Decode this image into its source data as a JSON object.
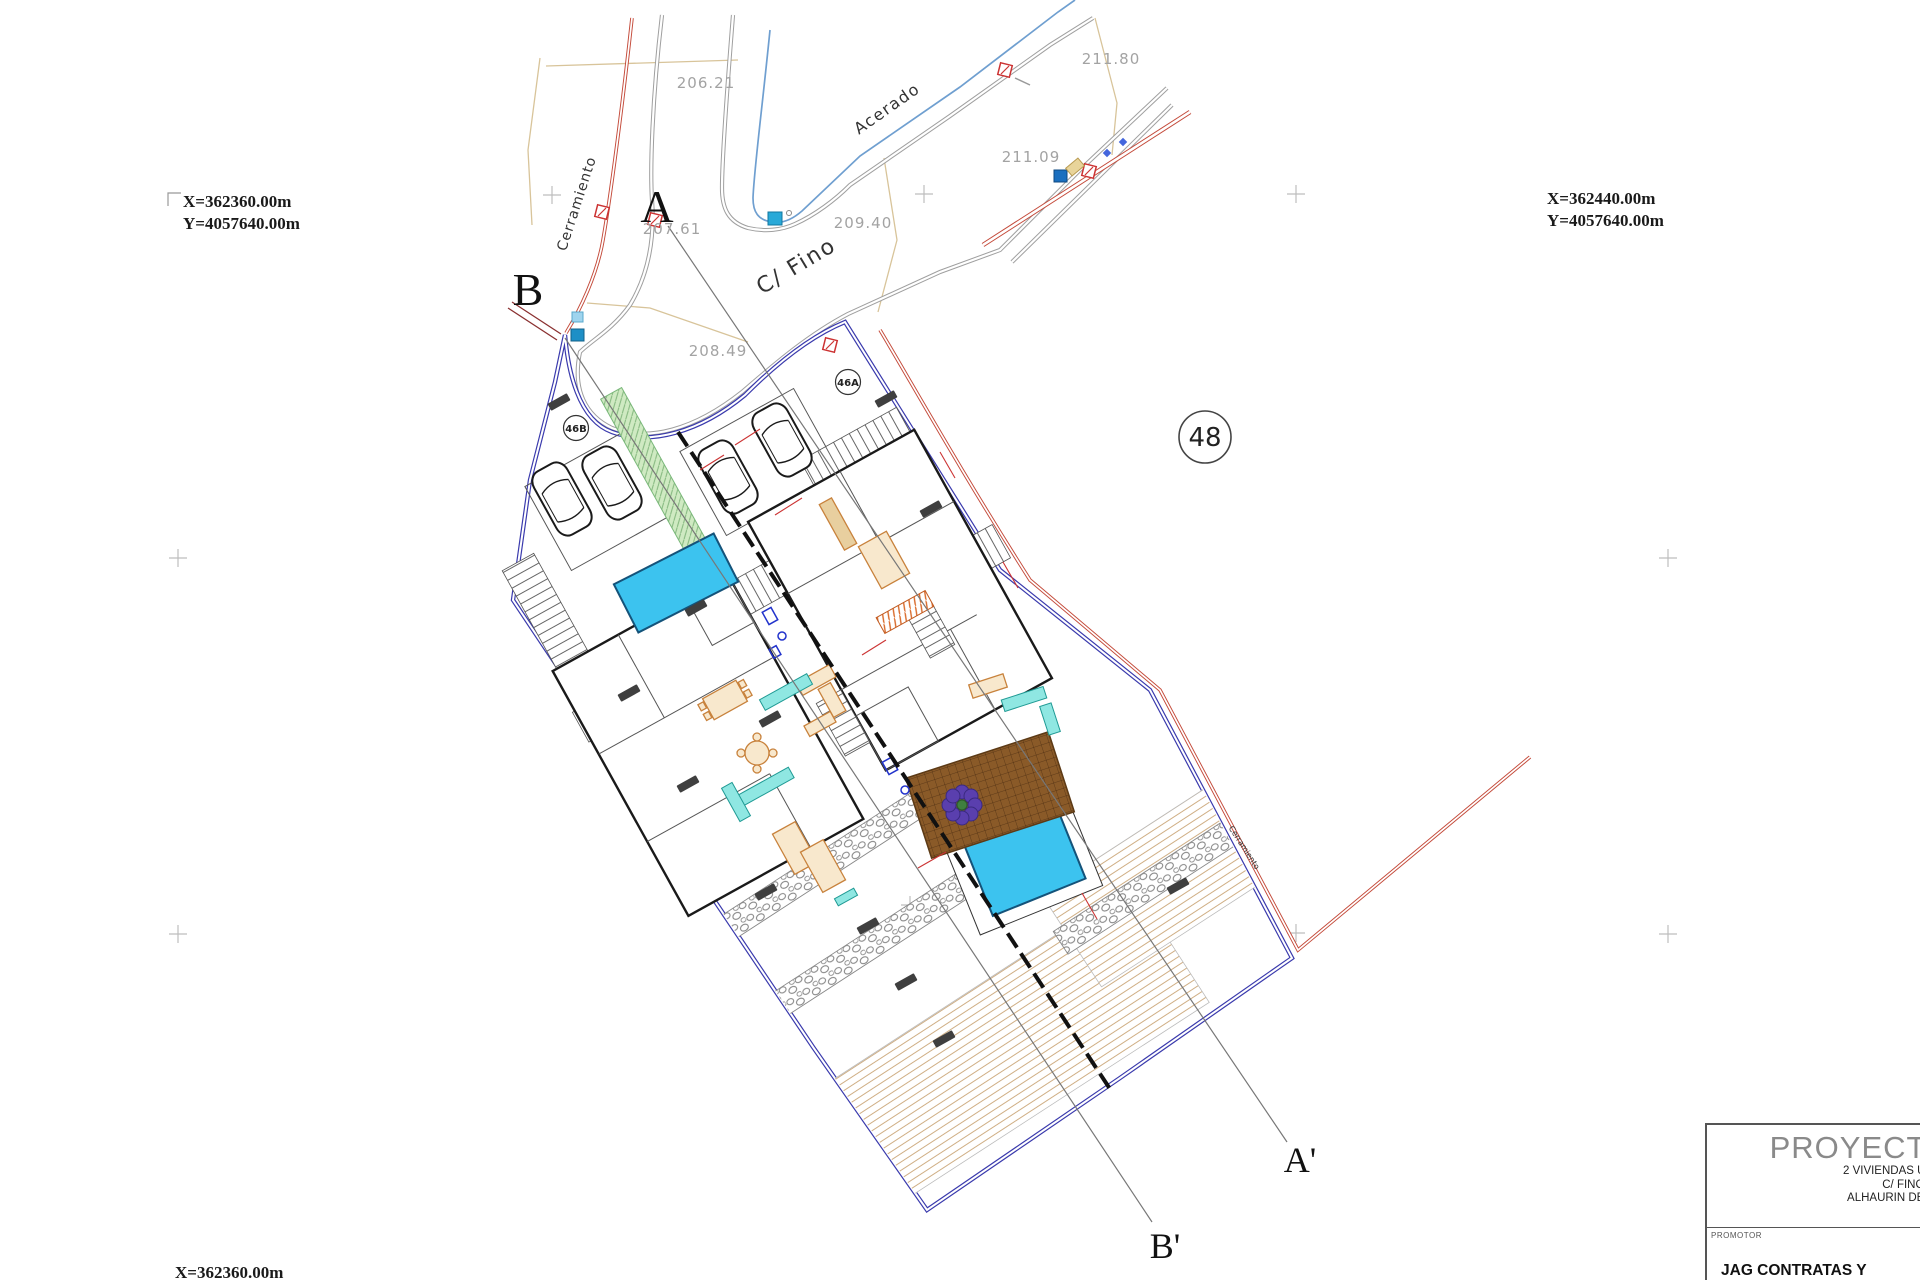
{
  "coords": {
    "top_left_x": "X=362360.00m",
    "top_left_y": "Y=4057640.00m",
    "top_right_x": "X=362440.00m",
    "top_right_y": "Y=4057640.00m",
    "bottom_left_x": "X=362360.00m"
  },
  "sections": {
    "a": "A",
    "a_prime": "A'",
    "b": "B",
    "b_prime": "B'"
  },
  "parcels": {
    "p46a": "46A",
    "p46b": "46B",
    "p48": "48"
  },
  "streets": {
    "name": "C/ Fino",
    "sidewalk": "Acerado",
    "fence_left": "Cerramiento",
    "fence_right": "Cerramiento"
  },
  "elevations": {
    "e1": "206.21",
    "e2": "207.61",
    "e3": "208.49",
    "e4": "209.40",
    "e5": "211.09",
    "e6": "211.80"
  },
  "title_block": {
    "project": "PROYECTO",
    "line1": "2 VIVIENDAS UNIFA",
    "line2": "C/ FINO nº46",
    "line3": "ALHAURIN DE LA T",
    "promoter_label": "PROMOTOR",
    "promoter_name": "JAG CONTRATAS Y"
  },
  "colors": {
    "pool": "#3cc3ef",
    "boundary": "#3a3aad",
    "fence": "#c44a3a",
    "road": "#9f9f9f",
    "water_line": "#6f9fd0",
    "green": "#cfeac2",
    "terrace_brown": "#8a5a28"
  }
}
